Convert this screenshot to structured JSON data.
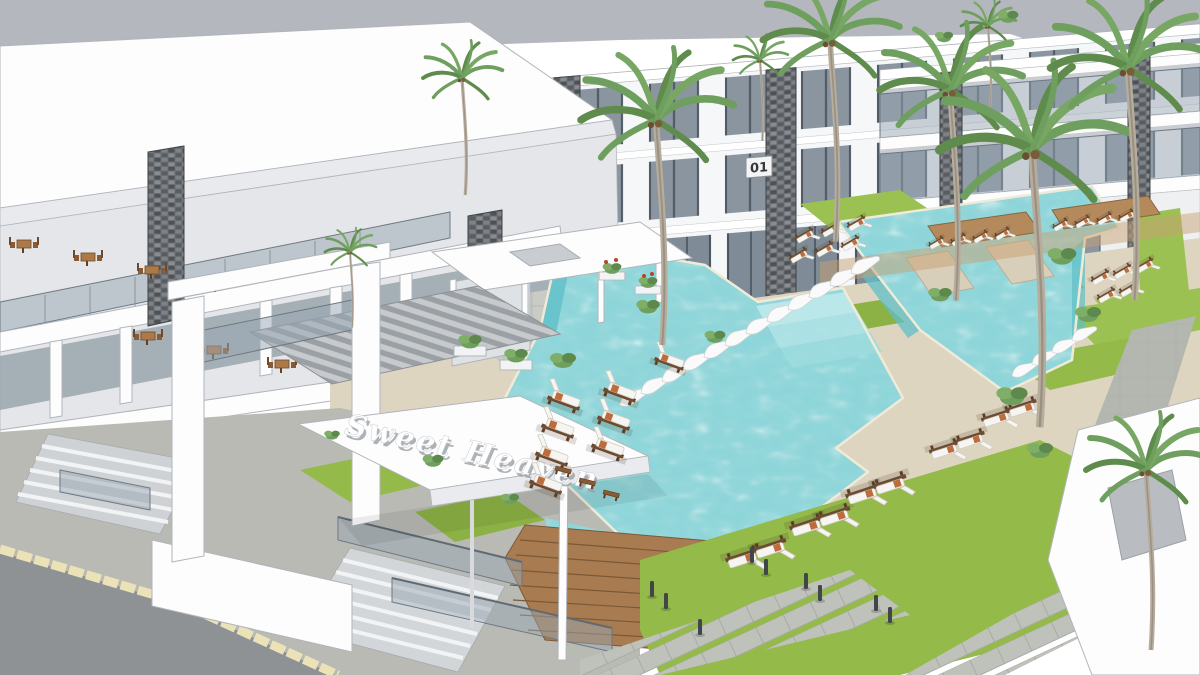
{
  "scene": {
    "sign_text": "Sweet Heaven",
    "building_number": "01"
  },
  "palette": {
    "backdrop": "#b5b7be",
    "wall": "#f6f7f8",
    "wall_shade": "#e4e6e9",
    "window_glass": "#8a95a0",
    "stone": "#6b6f73",
    "pool": "#8ed5d9",
    "pool_deep": "#5fbfc7",
    "deck": "#ded5c0",
    "wood": "#a87c50",
    "grass": "#94ba4a",
    "road": "#8f9295",
    "sidewalk": "#b9bab4",
    "curb": "#ece2b8",
    "lounger_cushion": "#f6f5f1",
    "lounger_frame": "#6d4b31",
    "towel": "#bf6c3c",
    "foliage": "#6f9f5e",
    "trunk": "#b6ad9d",
    "sign_text_color": "#ffffff"
  }
}
